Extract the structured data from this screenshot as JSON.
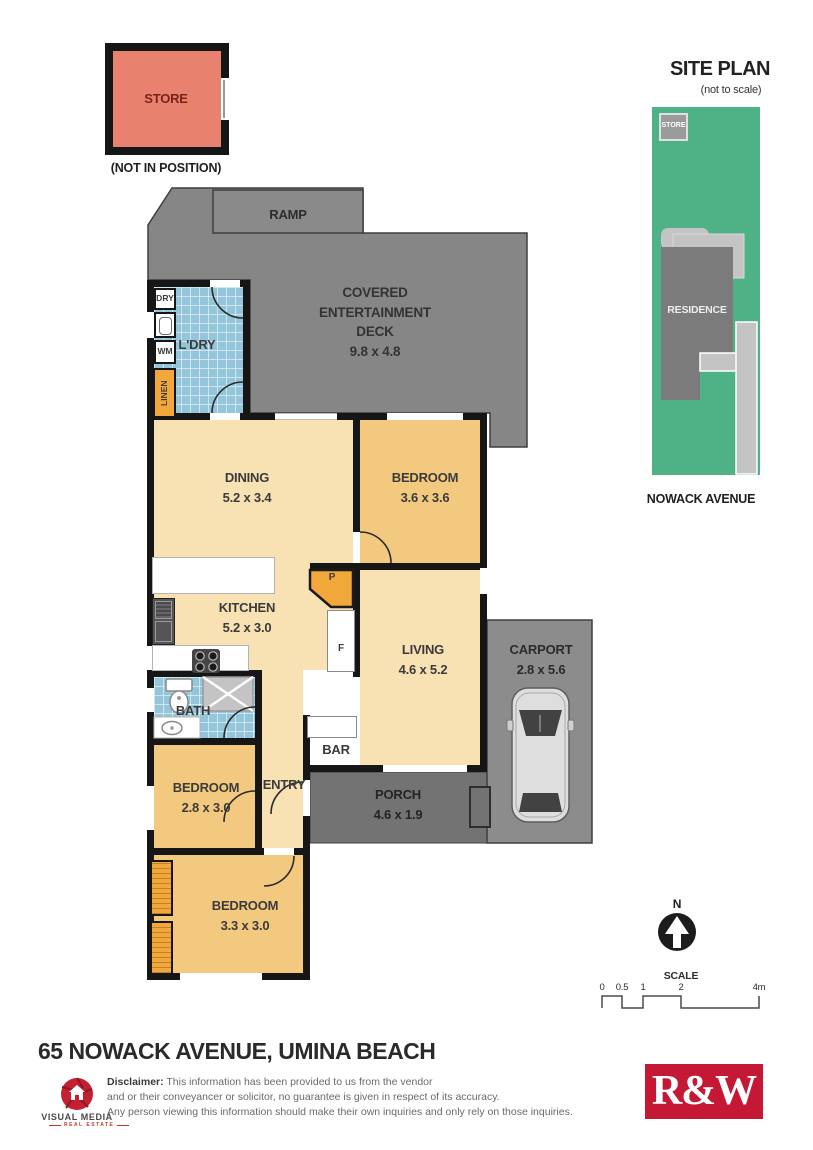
{
  "colors": {
    "site_green": "#4fb287",
    "store_salmon": "#e8826f",
    "plan_gray": "#868686",
    "porch_gray": "#737373",
    "carport_gray": "#8c8c8c",
    "room_cream": "#f8e2b4",
    "room_tan": "#f3c97f",
    "accent_orange": "#f2a73a",
    "tile_blue": "#93c6da",
    "wall_black": "#161616",
    "rw_red": "#c51834",
    "logo_red": "#c32032"
  },
  "store_unit": {
    "label": "STORE",
    "note": "(NOT IN POSITION)"
  },
  "site_plan": {
    "title": "SITE PLAN",
    "subtitle": "(not to scale)",
    "store": "STORE",
    "residence": "RESIDENCE",
    "street": "NOWACK AVENUE"
  },
  "rooms": {
    "ramp": {
      "name": "RAMP"
    },
    "deck": {
      "lines": [
        "COVERED",
        "ENTERTAINMENT",
        "DECK"
      ],
      "dims": "9.8 x 4.8"
    },
    "laundry": {
      "name": "L'DRY",
      "fixtures": {
        "dryer": "DRY",
        "washer": "WM",
        "linen": "LINEN"
      }
    },
    "dining": {
      "name": "DINING",
      "dims": "5.2 x 3.4"
    },
    "bedroom1": {
      "name": "BEDROOM",
      "dims": "3.6 x 3.6"
    },
    "kitchen": {
      "name": "KITCHEN",
      "dims": "5.2 x 3.0",
      "pantry": "P",
      "fridge": "F"
    },
    "living": {
      "name": "LIVING",
      "dims": "4.6 x 5.2"
    },
    "carport": {
      "name": "CARPORT",
      "dims": "2.8 x 5.6"
    },
    "bath": {
      "name": "BATH"
    },
    "bar": {
      "name": "BAR"
    },
    "bedroom2": {
      "name": "BEDROOM",
      "dims": "2.8 x 3.0"
    },
    "entry": {
      "name": "ENTRY"
    },
    "porch": {
      "name": "PORCH",
      "dims": "4.6 x 1.9"
    },
    "bedroom3": {
      "name": "BEDROOM",
      "dims": "3.3 x 3.0"
    }
  },
  "compass": {
    "north": "N"
  },
  "scale_bar": {
    "title": "SCALE",
    "ticks": [
      "0",
      "0.5",
      "1",
      "2",
      "4m"
    ]
  },
  "footer": {
    "address": "65 NOWACK AVENUE, UMINA BEACH",
    "disclaimer_label": "Disclaimer:",
    "disclaimer_lines": [
      "This information has been provided to us from the vendor",
      "and or their conveyancer or solicitor, no guarantee is given in respect of its accuracy.",
      "Any person viewing this information should make their own inquiries and only rely on those inquiries."
    ],
    "visual_media": {
      "name": "VISUAL MEDIA",
      "tagline": "REAL ESTATE"
    },
    "agency_logo": "R&W"
  }
}
